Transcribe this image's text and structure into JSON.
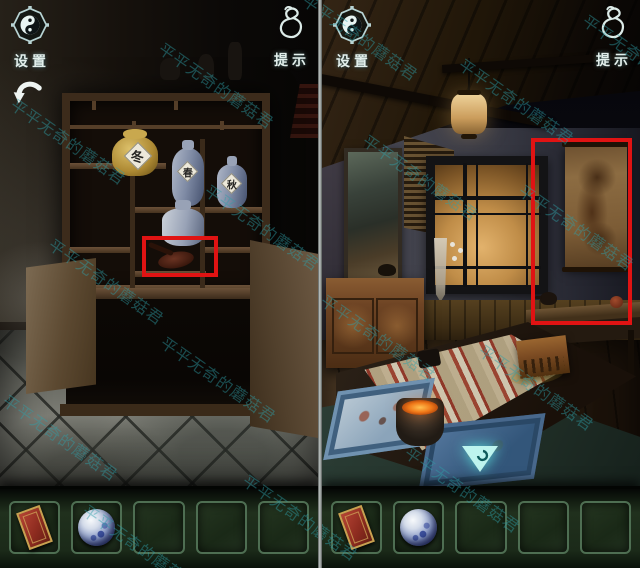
{
  "hud": {
    "settings_label": "设置",
    "hint_label": "提示"
  },
  "watermark": {
    "text": "平平无奇的蘑菇君",
    "color": "#2fa0a8"
  },
  "left_scene": {
    "name": "shelf-cabinet-room",
    "jar_label": "冬",
    "vase_labels": [
      "春",
      "秋"
    ]
  },
  "right_scene": {
    "name": "tea-room"
  },
  "inventory": {
    "slot_count": 5,
    "items": [
      {
        "slot": 1,
        "icon": "red-talisman-card"
      },
      {
        "slot": 2,
        "icon": "blue-porcelain-ball"
      }
    ]
  },
  "icons": {
    "settings": "yinyang-octagon-icon",
    "hint": "gourd-icon",
    "back": "undo-arrow-icon",
    "forward": "down-arrow-ornament-icon"
  },
  "colors": {
    "highlight_red": "#e01313",
    "inventory_green": "#1b2a19",
    "slot_border": "#4e6e52",
    "hud_text": "#e2efec"
  }
}
